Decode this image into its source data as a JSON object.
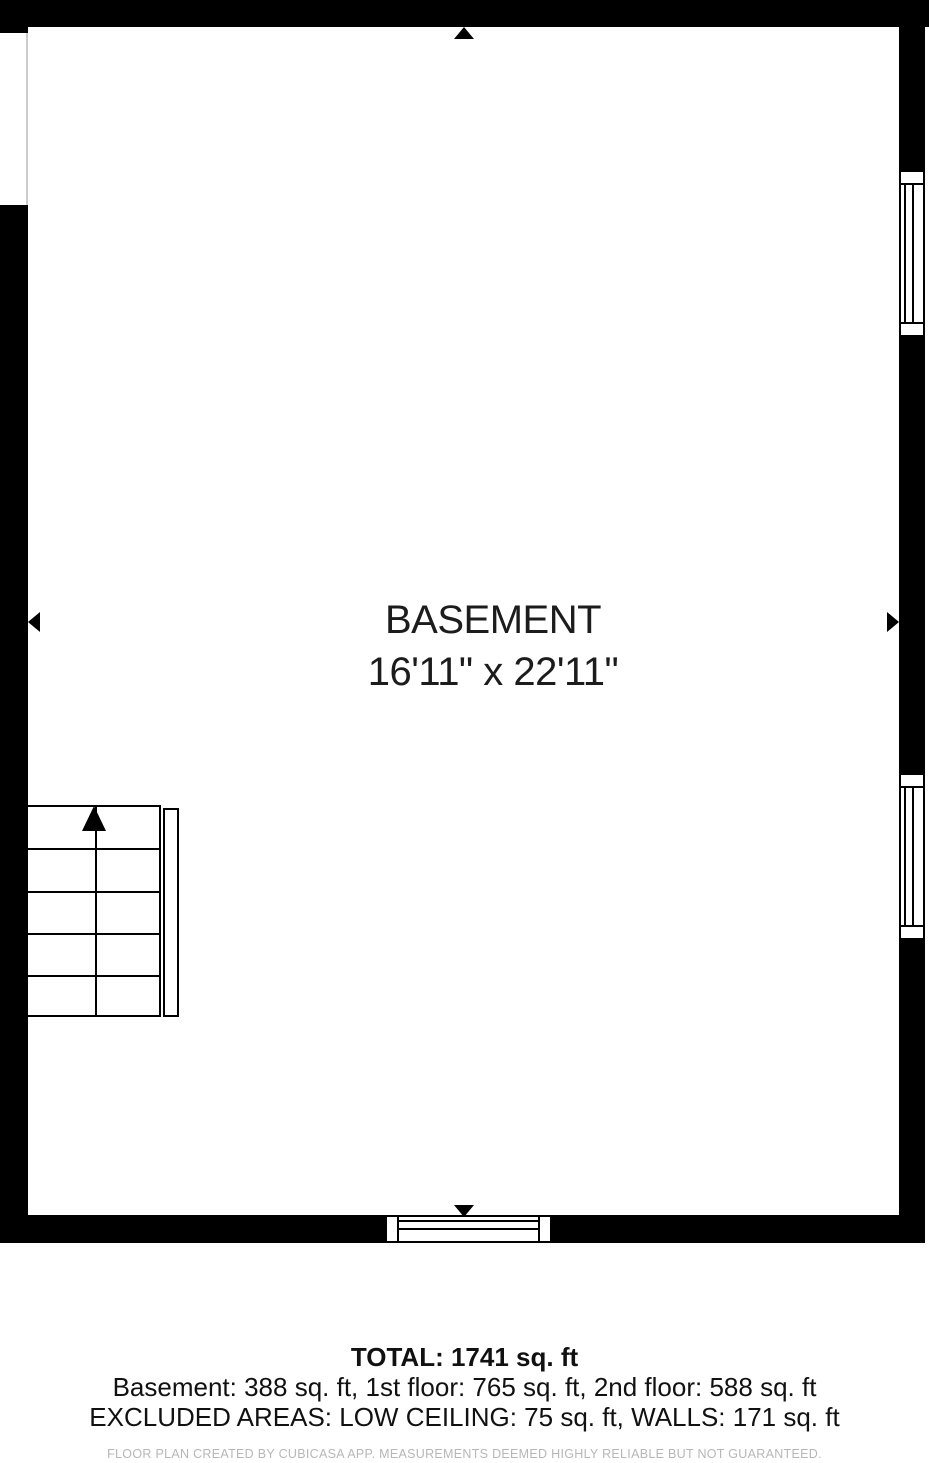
{
  "floor_plan": {
    "room": {
      "name": "BASEMENT",
      "dimensions": "16'11\" x 22'11\""
    },
    "summary": {
      "total": "TOTAL: 1741 sq. ft",
      "floor_breakdown": "Basement: 388 sq. ft, 1st floor: 765 sq. ft, 2nd floor: 588 sq. ft",
      "excluded_areas": "EXCLUDED AREAS: LOW CEILING: 75 sq. ft, WALLS: 171 sq. ft"
    },
    "footer_disclaimer": "FLOOR PLAN CREATED BY CUBICASA APP. MEASUREMENTS DEEMED HIGHLY RELIABLE BUT NOT GUARANTEED.",
    "icons": {
      "stair_direction": "up-arrow",
      "entrance_top": "up-triangle",
      "entrance_bottom": "down-triangle",
      "entrance_left": "left-triangle",
      "entrance_right": "right-triangle"
    },
    "colors": {
      "wall": "#000000",
      "background": "#ffffff",
      "room_text": "#1c1c1c",
      "summary_text": "#111111",
      "footer_text": "#b7b7b7"
    }
  }
}
